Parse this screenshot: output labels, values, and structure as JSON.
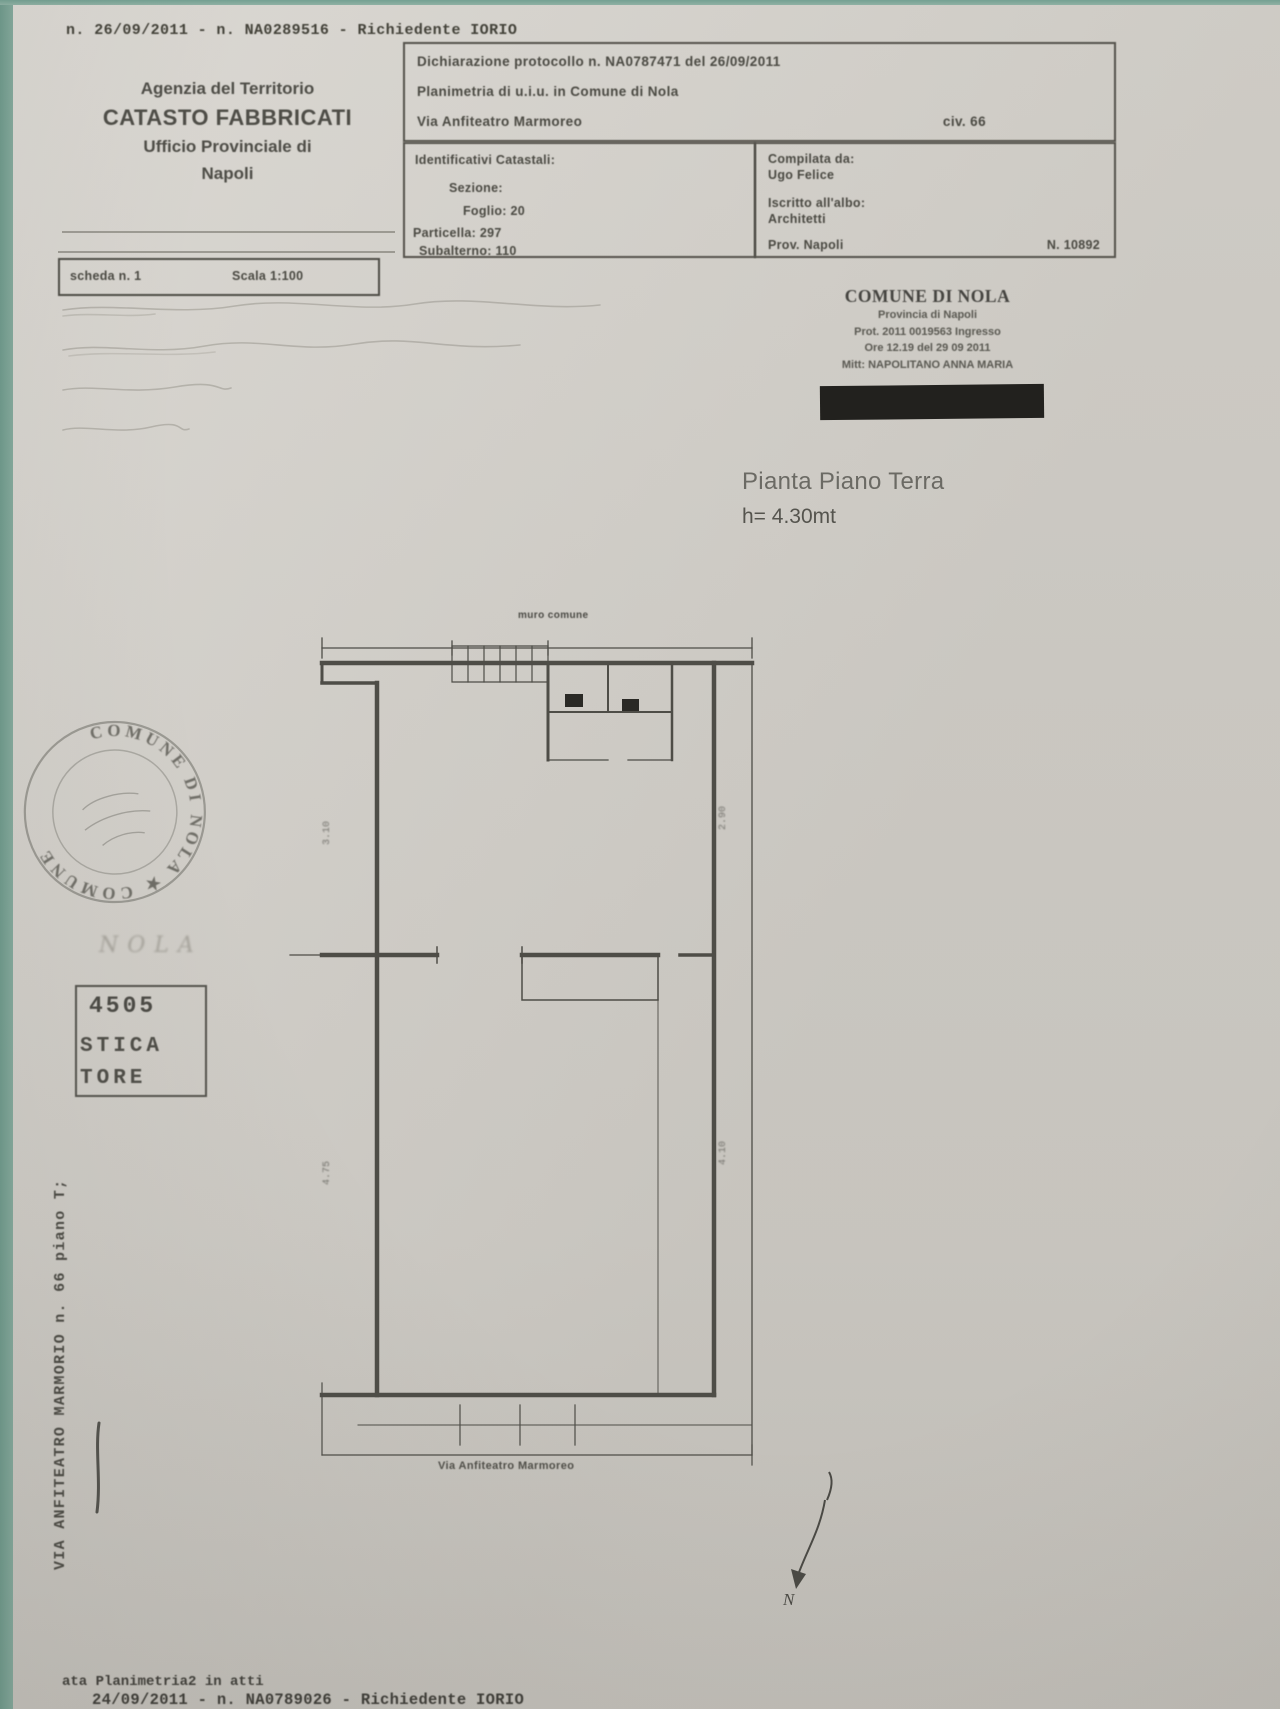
{
  "page": {
    "top_annotation": "n. 26/09/2011 - n. NA0289516 - Richiedente IORIO",
    "bottom_annotation_1": "ata Planimetria2 in atti",
    "bottom_annotation_2": "24/09/2011 - n. NA0789026 - Richiedente IORIO"
  },
  "agency_header": {
    "line1": "Agenzia del Territorio",
    "line2": "CATASTO FABBRICATI",
    "line3": "Ufficio Provinciale di",
    "line4": "Napoli"
  },
  "declaration_box": {
    "line1": "Dichiarazione protocollo n. NA0787471 del 26/09/2011",
    "line2": "Planimetria di u.i.u. in Comune di Nola",
    "line3_left": "Via Anfiteatro Marmoreo",
    "line3_right": "civ. 66"
  },
  "identifiers_box": {
    "title": "Identificativi Catastali:",
    "sezione": "Sezione:",
    "foglio": "Foglio: 20",
    "particella": "Particella: 297",
    "subalterno": "Subalterno: 110"
  },
  "compiler_box": {
    "title": "Compilata da:",
    "name": "Ugo Felice",
    "albo_label": "Iscritto all'albo:",
    "albo_value": "Architetti",
    "prov": "Prov. Napoli",
    "number": "N. 10892"
  },
  "sheet_bar": {
    "sheet": "scheda n. 1",
    "scale": "Scala 1:100"
  },
  "protocol_stamp": {
    "title": "COMUNE DI NOLA",
    "line2": "Provincia di Napoli",
    "line3": "Prot. 2011 0019563  Ingresso",
    "line4": "Ore 12.19  del 29 09 2011",
    "line5": "Mitt: NAPOLITANO ANNA MARIA"
  },
  "plan": {
    "title": "Pianta Piano Terra",
    "height_note": "h= 4.30mt",
    "top_label": "muro comune",
    "street_label": "Via Anfiteatro Marmoreo",
    "north_label": "N",
    "dims": {
      "left_top": "3.10",
      "left_bottom": "4.75",
      "right_top": "2.90",
      "right_bottom": "4.10"
    }
  },
  "round_stamp": {
    "arc_text": "COMUNE DI NOLA ★ COMUNE"
  },
  "side_marks": {
    "handwriting": "NOLA",
    "number": "4505",
    "fragment1": "STICA",
    "fragment2": "TORE"
  },
  "margin_note": "VIA ANFITEATRO MARMORIO n. 66 piano T;"
}
